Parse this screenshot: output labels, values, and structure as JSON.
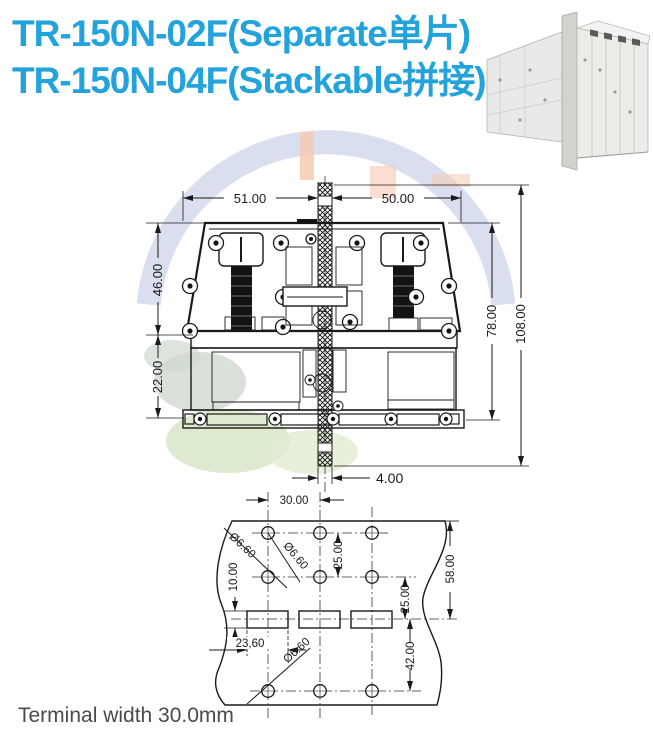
{
  "title": {
    "line1": "TR-150N-02F(Separate单片)",
    "line2": "TR-150N-04F(Stackable拼接)"
  },
  "caption": "Terminal width 30.0mm",
  "colors": {
    "title_blue": "#22a3dc",
    "drawing_line": "#1a1a1a",
    "watermark_ring": "#ccd4ea",
    "watermark_green": "#d9e8cb",
    "watermark_gray_green": "#d4dcd3",
    "watermark_peach": "#f6cab2",
    "photo_body": "#eaeae7"
  },
  "section_drawing": {
    "name": "terminal block cross-section",
    "dims": {
      "width_left": "51.00",
      "width_right": "50.00",
      "height_upper": "46.00",
      "height_lower": "22.00",
      "height_body": "78.00",
      "height_overall": "108.00",
      "column_width": "4.00"
    }
  },
  "drill_drawing": {
    "name": "panel drilling pattern",
    "dims": {
      "hole_pitch_x": "30.00",
      "row_pitch_upper": "25.00",
      "row_to_slot": "25.00",
      "slot_height": "10.00",
      "edge_to_slot": "58.00",
      "slot_to_bottom_row": "42.00",
      "slot_width": "23,60",
      "hole_dia_top": "Ø6.60",
      "hole_dia_mid": "Ø6.60",
      "hole_dia_bottom": "Ø6.60"
    }
  }
}
